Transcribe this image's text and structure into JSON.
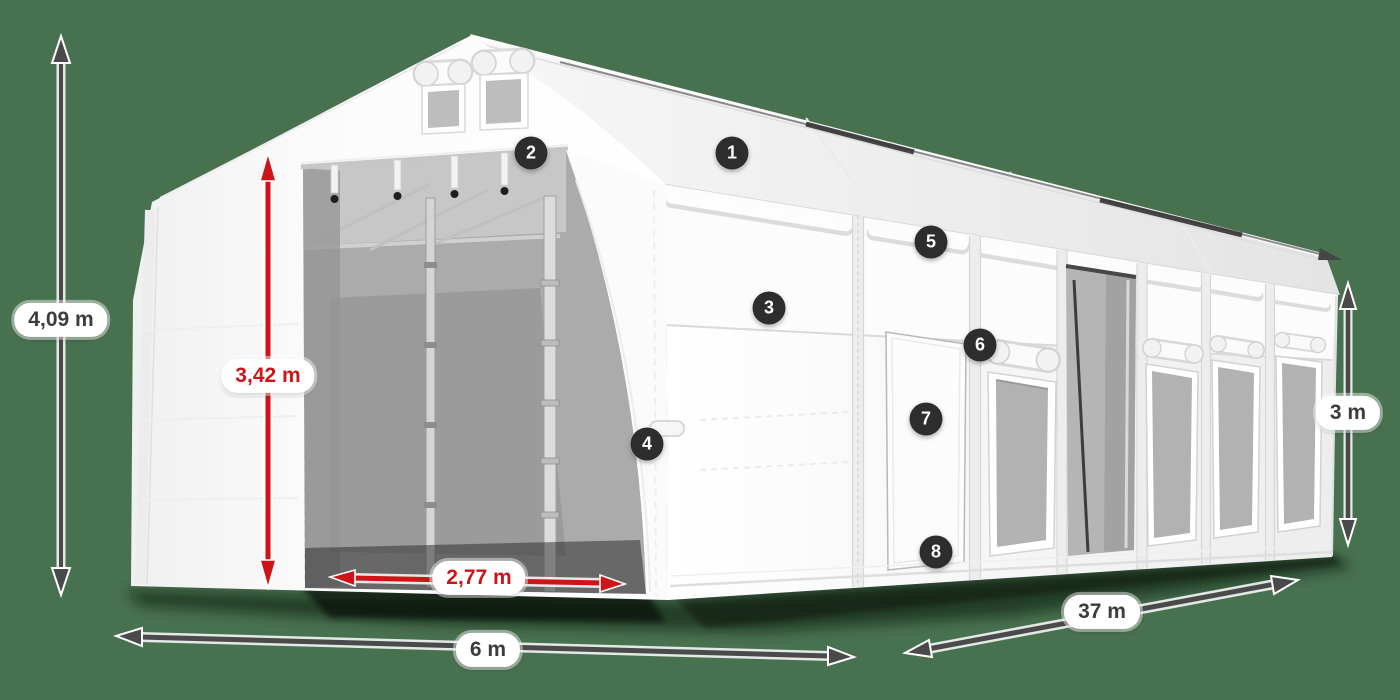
{
  "canvas": {
    "background": "#48714F"
  },
  "colors": {
    "arrow_dark": "#4A4A4A",
    "arrow_red": "#CE1418",
    "label_text_dark": "#3C3C3C",
    "label_text_red": "#CE1418",
    "label_pill_bg": "#FFFFFF",
    "badge_bg": "#2D2D2D",
    "badge_text": "#FFFFFF",
    "tent_white": "#F7F7F7",
    "interior_gray": "#ABABAB",
    "mesh_gray": "#B2B2B2"
  },
  "dimension_labels": [
    {
      "id": "total-height",
      "text": "4,09 m",
      "style": "dark"
    },
    {
      "id": "inner-height",
      "text": "3,42 m",
      "style": "red"
    },
    {
      "id": "door-width",
      "text": "2,77 m",
      "style": "red"
    },
    {
      "id": "front-width",
      "text": "6 m",
      "style": "dark"
    },
    {
      "id": "length",
      "text": "37 m",
      "style": "dark"
    },
    {
      "id": "side-height",
      "text": "3 m",
      "style": "dark"
    }
  ],
  "hotspots": [
    {
      "number": "1"
    },
    {
      "number": "2"
    },
    {
      "number": "3"
    },
    {
      "number": "4"
    },
    {
      "number": "5"
    },
    {
      "number": "6"
    },
    {
      "number": "7"
    },
    {
      "number": "8"
    }
  ]
}
